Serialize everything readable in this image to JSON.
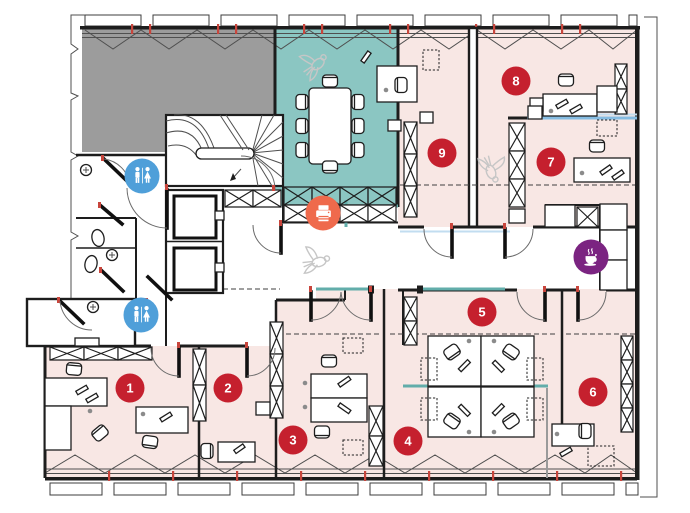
{
  "page": {
    "type": "office-floor-plan",
    "visible_text_note": "only room number badges are textual"
  },
  "colors": {
    "room_pink": "#f8e7e4",
    "meeting_room_teal": "#8bc6c2",
    "unassigned_gray": "#9c9c9c",
    "badge_red": "#c5202e",
    "restroom_blue": "#4f9fd9",
    "printer_orange": "#ef6a4c",
    "coffee_purple": "#7b2481",
    "glass_partition_teal": "#62adaa",
    "glass_partition_blue": "#85bce2",
    "wall_black": "#1d1d1d"
  },
  "rooms": [
    {
      "label": "1",
      "x": 130,
      "y": 388
    },
    {
      "label": "2",
      "x": 228,
      "y": 388
    },
    {
      "label": "3",
      "x": 293,
      "y": 440
    },
    {
      "label": "4",
      "x": 408,
      "y": 441
    },
    {
      "label": "5",
      "x": 482,
      "y": 312
    },
    {
      "label": "6",
      "x": 593,
      "y": 392
    },
    {
      "label": "7",
      "x": 551,
      "y": 162
    },
    {
      "label": "8",
      "x": 516,
      "y": 81
    },
    {
      "label": "9",
      "x": 442,
      "y": 153
    }
  ],
  "amenities": [
    {
      "id": "restroom-upper",
      "icon": "restroom",
      "x": 142,
      "y": 176,
      "color": "#4f9fd9"
    },
    {
      "id": "restroom-lower",
      "icon": "restroom",
      "x": 141,
      "y": 315,
      "color": "#4f9fd9"
    },
    {
      "id": "printer-station",
      "icon": "printer",
      "x": 323,
      "y": 213,
      "color": "#ef6a4c"
    },
    {
      "id": "coffee-point",
      "icon": "coffee",
      "x": 591,
      "y": 257,
      "color": "#7b2481"
    }
  ]
}
